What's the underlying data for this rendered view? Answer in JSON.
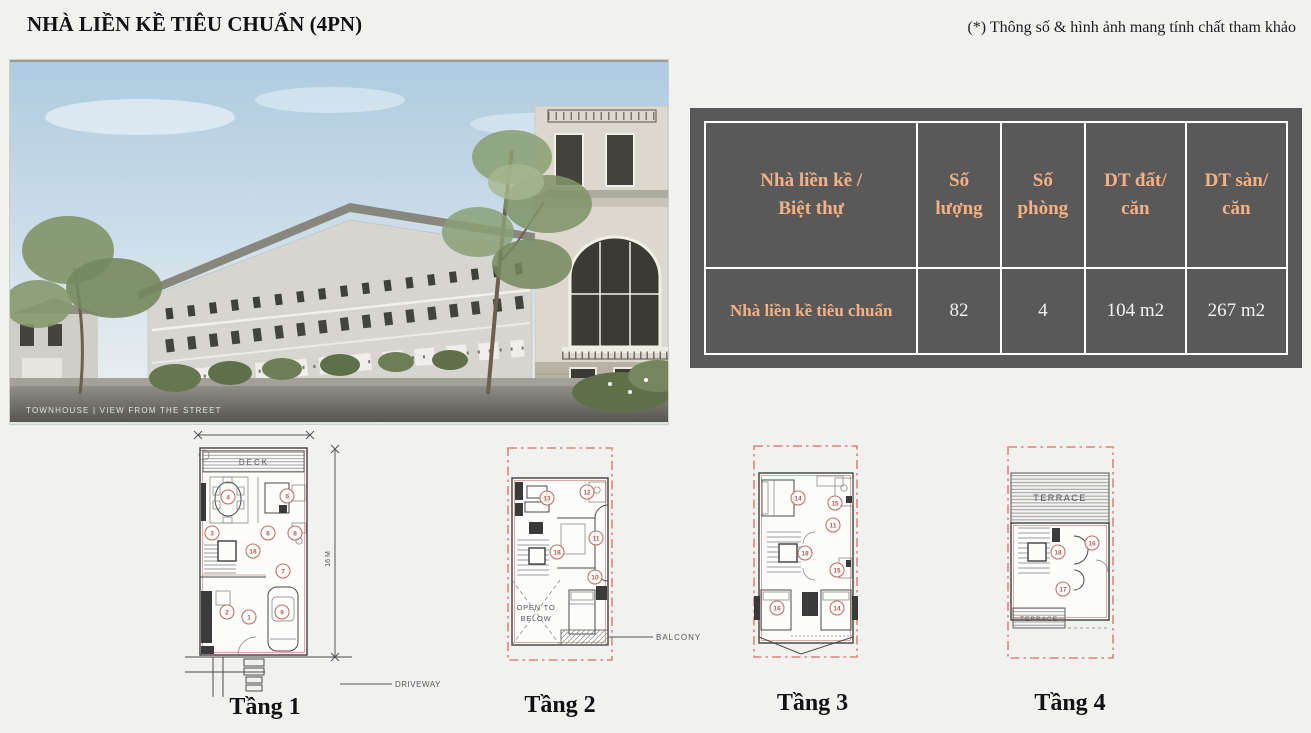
{
  "page": {
    "title": "NHÀ LIỀN KỀ TIÊU CHUẨN (4PN)",
    "note": "(*) Thông số & hình ảnh mang tính chất tham khảo"
  },
  "photo": {
    "caption": "TOWNHOUSE | VIEW FROM THE STREET"
  },
  "spec_table": {
    "headers": [
      "Nhà liền kề /\nBiệt thự",
      "Số\nlượng",
      "Số\nphòng",
      "DT đất/\ncăn",
      "DT sàn/\ncăn"
    ],
    "row": {
      "name": "Nhà liền kề tiêu chuẩn",
      "quantity": "82",
      "rooms": "4",
      "land_area_per_unit": "104 m2",
      "floor_area_per_unit": "267 m2"
    },
    "colors": {
      "background": "#595959",
      "header_text": "#F5B183",
      "value_text": "#F2F2F2",
      "border": "#FFFFFF"
    }
  },
  "floor_plans": {
    "floor1": {
      "label": "Tầng 1",
      "deck_label": "DECK",
      "driveway_label": "DRIVEWAY",
      "height_dimension": "16 M",
      "room_markers": [
        "4",
        "5",
        "3",
        "6",
        "8",
        "18",
        "7",
        "2",
        "1",
        "9"
      ]
    },
    "floor2": {
      "label": "Tầng 2",
      "open_to_below_line1": "OPEN TO",
      "open_to_below_line2": "BELOW",
      "balcony_label": "BALCONY",
      "room_markers": [
        "13",
        "12",
        "11",
        "18",
        "10"
      ]
    },
    "floor3": {
      "label": "Tầng 3",
      "room_markers": [
        "14",
        "15",
        "11",
        "18",
        "15",
        "16",
        "14"
      ]
    },
    "floor4": {
      "label": "Tầng 4",
      "terrace_top_label": "TERRACE",
      "terrace_bottom_label": "TERRACE",
      "room_markers": [
        "16",
        "18",
        "17"
      ]
    }
  }
}
